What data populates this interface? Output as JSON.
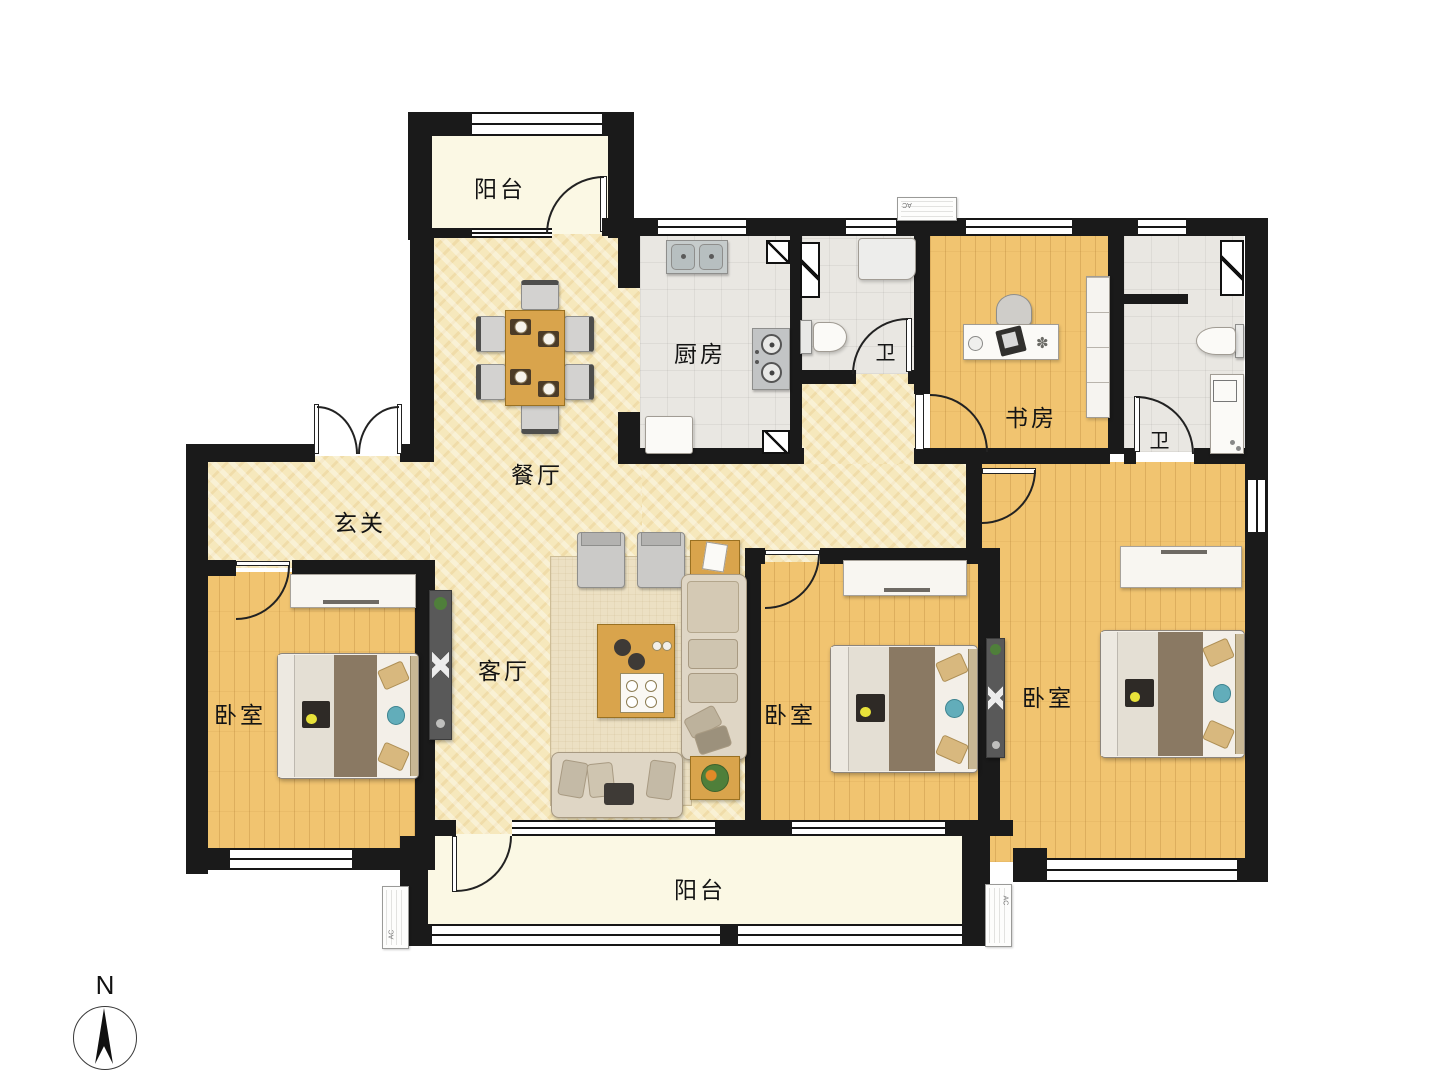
{
  "rooms": {
    "balcony_top": {
      "label": "阳台"
    },
    "kitchen": {
      "label": "厨房"
    },
    "bath1": {
      "label": "卫"
    },
    "study": {
      "label": "书房"
    },
    "bath2": {
      "label": "卫"
    },
    "dining": {
      "label": "餐厅"
    },
    "entry": {
      "label": "玄关"
    },
    "living": {
      "label": "客厅"
    },
    "bedroom_left": {
      "label": "卧室"
    },
    "bedroom_middle": {
      "label": "卧室"
    },
    "bedroom_right": {
      "label": "卧室"
    },
    "balcony_bottom": {
      "label": "阳台"
    }
  },
  "compass": {
    "label": "N"
  },
  "ac": {
    "label": "AC"
  },
  "colors": {
    "wall": "#1a1a1a",
    "marble_floor": "#F6E8BC",
    "wood_floor": "#F1C470",
    "tile_floor": "#E9E7E2",
    "balcony_floor": "#FBF8E4",
    "furniture_wood": "#D9A44C",
    "blanket_brown": "#8A7963",
    "pillow_teal": "#62ADBA"
  }
}
